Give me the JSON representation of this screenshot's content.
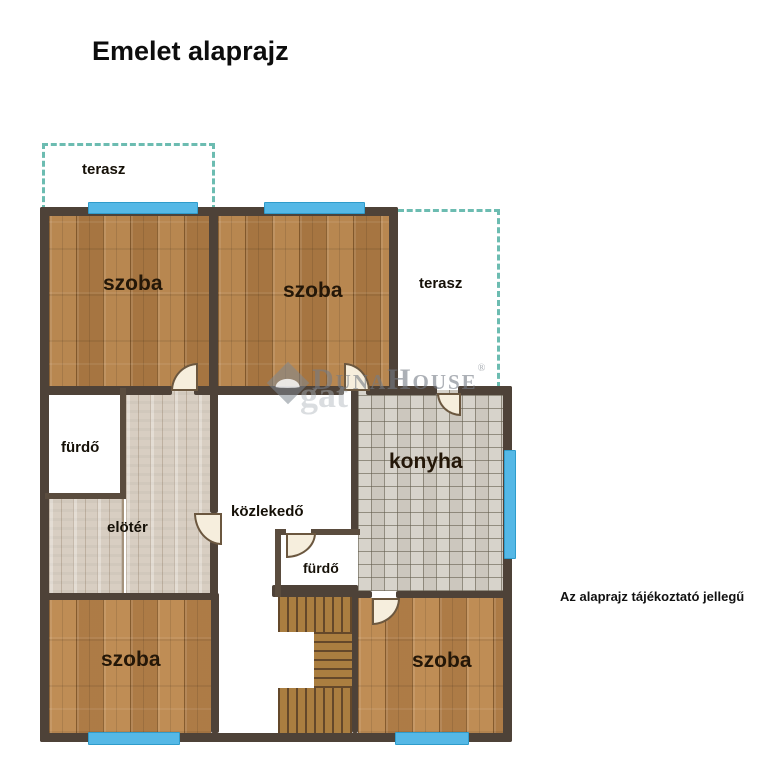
{
  "title": "Emelet alaprajz",
  "disclaimer": "Az alaprajz tájékoztató jellegű",
  "watermark": {
    "brand": "DunaHouse",
    "registered": "®",
    "fragment": "gat"
  },
  "rooms": {
    "terasz_top": "terasz",
    "szoba_top_left": "szoba",
    "szoba_top_mid": "szoba",
    "terasz_right": "terasz",
    "furdo_upper": "fürdő",
    "eloter": "elötér",
    "kozlekedo": "közlekedő",
    "konyha": "konyha",
    "furdo_lower": "fürdő",
    "szoba_bottom_left": "szoba",
    "szoba_bottom_right": "szoba"
  },
  "colors": {
    "wall": "#4e4238",
    "window": "#55b8e6",
    "terrace_dash": "#6cbcb1",
    "wood_floor": "#b07c45",
    "wood_floor_bottom": "#b8834a",
    "tile_floor": "#d3cec5",
    "hall_floor": "#d8cec2",
    "stairs": "#aa7e40",
    "door_fill": "#f6eedd",
    "label_text": "#151007",
    "watermark_gray": "#747c86"
  }
}
